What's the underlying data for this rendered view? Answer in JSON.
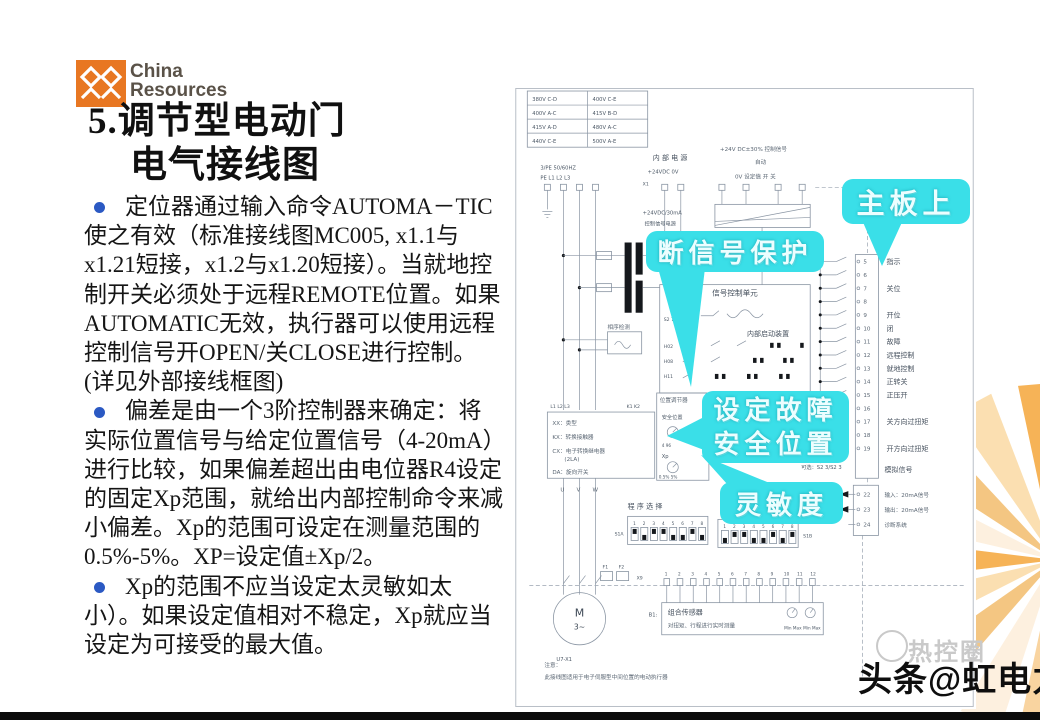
{
  "slide": {
    "logo_brand_line1": "China",
    "logo_brand_line2": "Resources",
    "title_line1": "5.调节型电动门",
    "title_line2": "电气接线图",
    "bullets": [
      {
        "text": "定位器通过输入命令AUTOMA－TIC使之有效（标准接线图MC005, x1.1与x1.21短接，x1.2与x1.20短接）。当就地控制开关必须处于远程REMOTE位置。如果AUTOMATIC无效，执行器可以使用远程控制信号开OPEN/关CLOSE进行控制。(详见外部接线框图)"
      },
      {
        "text": "偏差是由一个3阶控制器来确定：将实际位置信号与给定位置信号（4-20mA）进行比较，如果偏差超出由电位器R4设定的固定Xp范围，就给出内部控制命令来减小偏差。Xp的范围可设定在测量范围的0.5%-5%。XP=设定值±Xp/2。"
      },
      {
        "text": "Xp的范围不应当设定太灵敏如太小）。如果设定值相对不稳定，Xp就应当设定为可接受的最大值。"
      }
    ]
  },
  "diagram": {
    "voltage_table": [
      "380V C-D",
      "400V C-E",
      "400V A-C",
      "415V B-D",
      "415V A-D",
      "480V A-C",
      "440V C-E",
      "500V A-E"
    ],
    "labels": {
      "freq": "3/PE 50/60HZ",
      "pe_row": "PE   L1   L2   L3",
      "x1": "X1",
      "internal_power": "内 部 电 源",
      "internal_power_vals": "+24VDC        0V",
      "ctrl_signal": "+24V DC±30%   控制信号",
      "auto": "自动",
      "ctrl_row": "0V    设定值     开     关",
      "ctrl_power1": "+24VDC/30mA",
      "ctrl_power2": "控制信号电源",
      "phase_check": "相序检测",
      "main_unit": "信号控制单元",
      "inner_device": "内部启动装置",
      "pin1": "S2 7",
      "pin2": "H02",
      "pin3": "H08",
      "pin4": "H11",
      "positioner": "位置调节器",
      "safe_pos": "安全位置",
      "knob1_caption": "4    96",
      "xp": "Xp",
      "xp_range": "0.5%  5%",
      "legend1": "XX：类型",
      "legend2": "KX：转换接触器",
      "legend3": "CX：电子转换继电器",
      "legend4": "(2LA)",
      "legend5": "DA：旋向开关",
      "l_row": "L1  L2  L3",
      "k_row": "K1 K2",
      "u": "U",
      "v": "V",
      "w": "W",
      "motor_m": "M",
      "motor_ph": "3~",
      "motor_tag": "U7-X1",
      "program_select": "程 序 选 择",
      "dip_numbers": "12345678",
      "dip_a": "S1A",
      "dip_b": "S1B",
      "f1": "F1",
      "f2": "F2",
      "x9": "X9",
      "sensor_numbers": [
        "1",
        "2",
        "3",
        "4",
        "5",
        "6",
        "7",
        "8",
        "9",
        "10",
        "11",
        "12"
      ],
      "sensor_tag": "B1:",
      "sensor_line1": "组合传感器",
      "sensor_line2": "对扭矩、行程进行实时测量",
      "minmax1": "Min Max",
      "minmax2": "Min Max",
      "optional": "可选：S2 3/S2 3",
      "analog": "模拟信号",
      "note_title": "注意：",
      "note_text": "此接线图适用于电子伺服型中间位置的电动执行器"
    },
    "terminals": [
      {
        "num": "5",
        "label": "指示"
      },
      {
        "num": "6",
        "label": ""
      },
      {
        "num": "7",
        "label": "关位"
      },
      {
        "num": "8",
        "label": ""
      },
      {
        "num": "9",
        "label": "开位"
      },
      {
        "num": "10",
        "label": "闭"
      },
      {
        "num": "11",
        "label": "故障"
      },
      {
        "num": "12",
        "label": "远程控制"
      },
      {
        "num": "13",
        "label": "就地控制"
      },
      {
        "num": "14",
        "label": "正转关"
      },
      {
        "num": "15",
        "label": "正压开"
      },
      {
        "num": "16",
        "label": ""
      },
      {
        "num": "17",
        "label": "关方向过扭矩"
      },
      {
        "num": "18",
        "label": ""
      },
      {
        "num": "19",
        "label": "开方向过扭矩"
      }
    ],
    "io_terminals": [
      {
        "num": "22",
        "label": "输入：20mA信号"
      },
      {
        "num": "23",
        "label": "输出：20mA信号"
      },
      {
        "num": "24",
        "label": "诊断系统"
      }
    ],
    "callouts": {
      "mainboard": "主板上",
      "signal_loss": "断信号保护",
      "failsafe_line1": "设定故障",
      "failsafe_line2": "安全位置",
      "sensitivity": "灵敏度"
    }
  },
  "watermark": {
    "circle_text": "热控圈",
    "main_text": "头条@虹电力"
  },
  "colors": {
    "callout_cyan": "#3adfe8",
    "bullet_blue": "#2b59c3",
    "brand_orange": "#e87722"
  }
}
